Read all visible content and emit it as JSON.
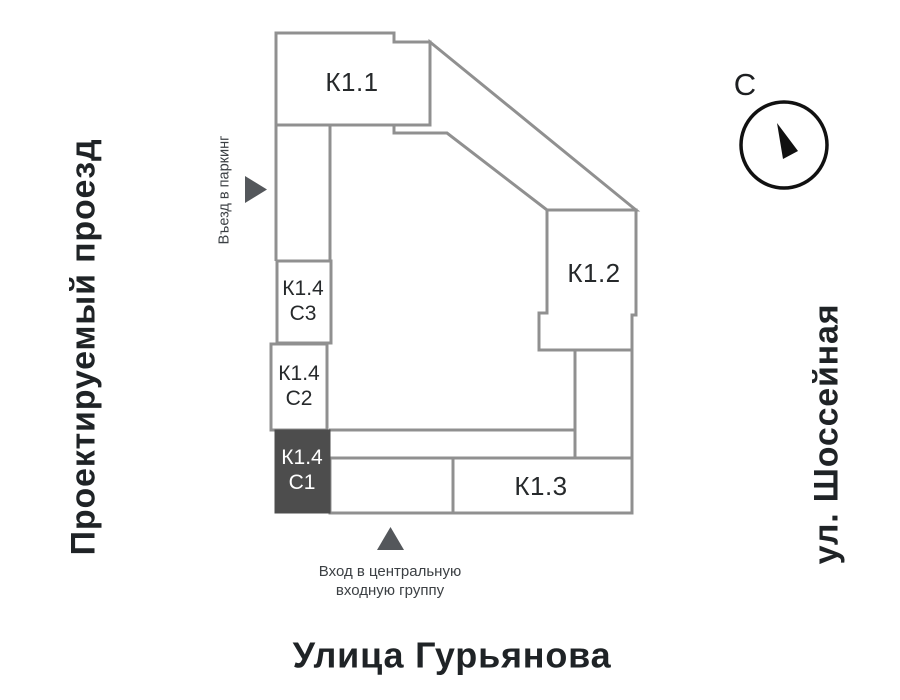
{
  "plan": {
    "buildings": {
      "k1_1": {
        "label": "К1.1"
      },
      "k1_2": {
        "label": "К1.2"
      },
      "k1_3": {
        "label": "К1.3"
      },
      "k1_4_c3": {
        "line1": "К1.4",
        "line2": "С3"
      },
      "k1_4_c2": {
        "line1": "К1.4",
        "line2": "С2"
      },
      "k1_4_c1": {
        "line1": "К1.4",
        "line2": "С1",
        "selected": true
      }
    },
    "colors": {
      "outline": "#909090",
      "selected_fill": "#4d4d4d",
      "selected_text": "#ffffff",
      "building_label_text": "#26292b",
      "street_text": "#1f2326",
      "annotation_text": "#3c4044",
      "marker_arrow": "#54575b",
      "compass_stroke": "#111111"
    }
  },
  "streets": {
    "left": "Проектируемый проезд",
    "right": "ул. Шоссейная",
    "bottom": "Улица Гурьянова"
  },
  "annotations": {
    "parking": "Въезд в паркинг",
    "entrance_line1": "Вход в центральную",
    "entrance_line2": "входную группу"
  },
  "compass": {
    "north_label": "С"
  }
}
